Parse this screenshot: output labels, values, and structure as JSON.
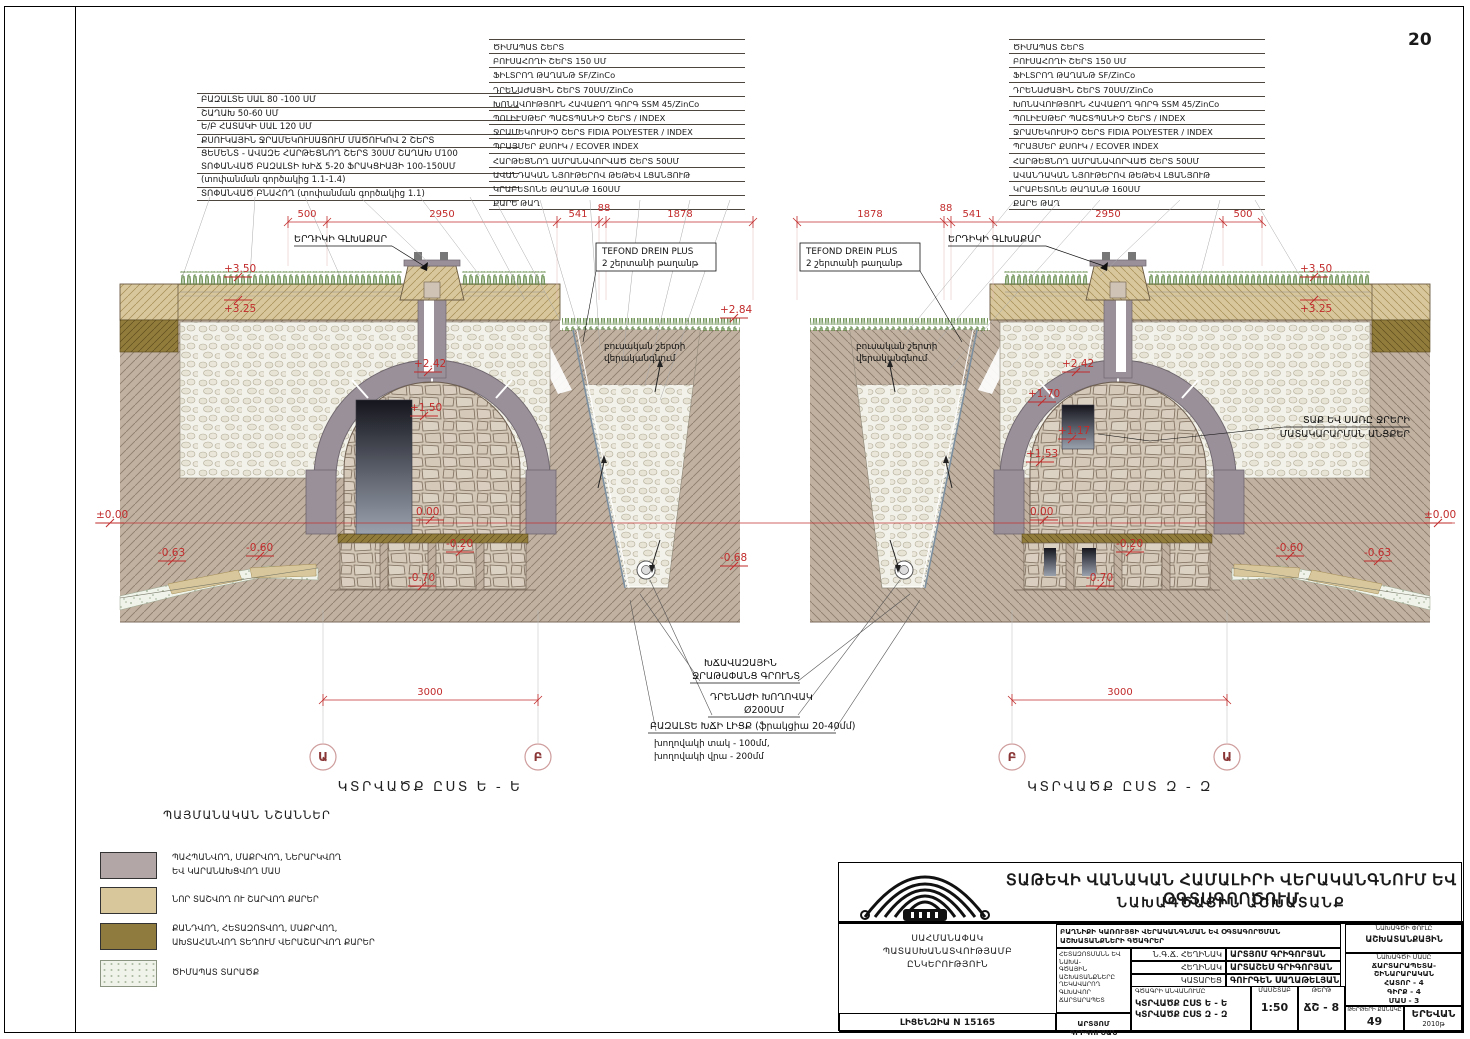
{
  "page": {
    "number": "20"
  },
  "colors": {
    "accent_red": "#c22b2b",
    "soil": "#c0b1a1",
    "roof_tan": "#d8c79d",
    "olive": "#927c3b",
    "stone": "#d2c6b6",
    "dome_gray": "#9a9099",
    "legend_mauve": "#b3a6a6",
    "legend_tan": "#d9c79c",
    "legend_olive": "#8f7b3e",
    "legend_speckle_bg": "#eff3ea"
  },
  "lists": {
    "floor_layers": [
      "ԲԱԶԱԼՏԵ ՍԱԼ 80 -100 ՍՄ",
      "ՇԱՂԱԽ 50-60 ՍՄ",
      "Ե/Բ ՀԱՏԱԿԻ ՍԱԼ 120 ՍՄ",
      "ՔՍՈՒԿԱՅԻՆ ՋՐԱՄԵԿՈՒՍԱՑՈՒՄ ՄԱԾՈՒԿՈՎ 2 ՇԵՐՏ",
      "ՑԵՄԵՆՏ - ԱՎԱԶԵ ՀԱՐԹԵՑՆՈՂ ՇԵՐՏ 30ՍՄ ՇԱՂԱԽ Մ100",
      "ՏՈՓԱՆՎԱԾ ԲԱԶԱԼՏԻ ԽԻՃ 5-20 ՖՐԱԿՑԻԱՅԻ 100-150ՍՄ",
      "(տոփանման գործակից 1.1-1.4)",
      "ՏՈՓԱՆՎԱԾ ԲՆԱՀՈՂ (տոփանման գործակից 1.1)"
    ],
    "roof_layers": [
      "ԾԻՄԱՊԱՏ ՇԵՐՏ",
      "ԲՈՒՍԱՀՈՂԻ ՇԵՐՏ 150 ՍՄ",
      "ՖԻԼՏՐՈՂ ԹԱՂԱՆԹ SF/ZinCo",
      "ԴՐԵՆԱԺԱՅԻՆ ՇԵՐՏ 70ՍՄ/ZinCo",
      "ԽՈՆԱՎՈՒԹՅՈՒՆ ՀԱՎԱՔՈՂ ԳՈՐԳ SSM 45/ZinCo",
      "ՊՈԼԻԷՍԹԵՐ ՊԱՇՏՊԱՆԻՉ ՇԵՐՏ / INDEX",
      "ՋՐԱՄԵԿՈՒՍԻՉ ՇԵՐՏ FIDIA POLYESTER / INDEX",
      "ՊՐԱՅՄԵՐ ՔՍՈՒԿ / ECOVER INDEX",
      "ՀԱՐԹԵՑՆՈՂ ԱՄՐԱՆԱՎՈՐՎԱԾ ՇԵՐՏ 50ՍՄ",
      "ԱՎԱՆԴԱԿԱՆ ՆՅՈՒԹԵՐՈՎ ԹԵԹԵՎ ԼՑԱՆՅՈՒԹ",
      "ԿՐԱԲԵՏՈՆԵ ԹԱՂԱՆԹ 160ՍՄ",
      "ՔԱՐԵ ԹԱՂ"
    ]
  },
  "sections": {
    "left": {
      "title": "ԿՏՐՎԱԾՔ ԸՍՏ Ե - Ե",
      "axis_a": "Ա",
      "axis_b": "Բ",
      "span": "3000",
      "dims": [
        "500",
        "2950",
        "541",
        "88",
        "1878"
      ],
      "marks": {
        "p350": "+3.50",
        "p325": "+3.25",
        "zero": "±0.00",
        "m063": "-0.63",
        "m060": "-0.60",
        "p242": "+2.42",
        "p150": "+1.50",
        "floor": "0.00",
        "m020": "-0.20",
        "m070": "-0.70",
        "p284": "+2.84",
        "m068": "-0.68"
      },
      "skylight": "ԵՐԴԻԿԻ ԳԼԽԱՔԱՐ",
      "tefond1": "TEFOND DREIN PLUS",
      "tefond2": "2 շերտանի թաղանթ",
      "veg1": "բուսական շերտի",
      "veg2": "վերականգնում"
    },
    "right": {
      "title": "ԿՏՐՎԱԾՔ ԸՍՏ Զ - Զ",
      "axis_a": "Ա",
      "axis_b": "Բ",
      "span": "3000",
      "dims": [
        "1878",
        "88",
        "541",
        "2950",
        "500"
      ],
      "marks": {
        "p350": "+3.50",
        "p325": "+3.25",
        "zero": "±0.00",
        "m063": "-0.63",
        "m060": "-0.60",
        "p242": "+2.42",
        "p170": "+1.70",
        "p117": "+1.17",
        "p153": "+1.53",
        "floor": "0.00",
        "m020": "-0.20",
        "m070": "-0.70"
      },
      "skylight": "ԵՐԴԻԿԻ ԳԼԽԱՔԱՐ",
      "tefond1": "TEFOND DREIN PLUS",
      "tefond2": "2 շերտանի թաղանթ",
      "veg1": "բուսական շերտի",
      "veg2": "վերականգնում",
      "water1": "ՏԱՔ ԵՎ ՍԱՌԸ ՋՐԵՐԻ",
      "water2": "ՄԱՏԱԿԱՐԱՐՄԱՆ ԱՆՑՔԵՐ"
    }
  },
  "notes": {
    "gravel1": "ԽՃԱՎԱԶԱՅԻՆ",
    "gravel2": "ՋՐԱԹԱՓԱՆՑ ԳՐՈՒՆՏ",
    "pipe1": "ԴՐԵՆԱԺԻ ԽՈՂՈՎԱԿ",
    "pipe2": "Ø200ՍՄ",
    "basalt1": "ԲԱԶԱԼՏԵ ԽՃԻ ԼԻՑՔ (ֆրակցիա 20-40մմ)",
    "basalt2": "խողովակի տակ - 100մմ,",
    "basalt3": "խողովակի վրա - 200մմ"
  },
  "legend": {
    "title": "ՊԱՅՄԱՆԱԿԱՆ ՆՇԱՆՆԵՐ",
    "items": [
      {
        "line1": "ՊԱՀՊԱՆՎՈՂ, ՄԱՔՐՎՈՂ, ՆԵՐԱՐԿՎՈՂ",
        "line2": "ԵՎ ԿԱՐԱՆԱԽՑՎՈՂ ՄԱՍ"
      },
      {
        "line1": "ՆՈՐ ՏԱՇՎՈՂ ՈՒ ՇԱՐՎՈՂ ՔԱՐԵՐ",
        "line2": ""
      },
      {
        "line1": "ՔԱՆԴՎՈՂ, ՀԵՏԱԶՈՏՎՈՂ, ՄԱՔՐՎՈՂ,",
        "line2": "ԱԽՏԱՀԱՆՎՈՂ ՏԵՂՈՒՄ ՎԵՐԱՇԱՐՎՈՂ ՔԱՐԵՐ"
      },
      {
        "line1": "ԾԻՄԱՊԱՏ ՏԱՐԱԾՔ",
        "line2": ""
      }
    ]
  },
  "titleblock": {
    "project_title1": "ՏԱԹԵՎԻ ՎԱՆԱԿԱՆ ՀԱՄԱԼԻՐԻ ՎԵՐԱԿԱՆԳՆՈՒՄ ԵՎ ՕԳՏԱԳՈՐԾՈՒՄ",
    "project_title2": "ՆԱԽԱԳԾԱՅԻՆ ԱՇԽԱՏԱՆՔ",
    "company1": "ՍԱՀՄԱՆԱՓԱԿ",
    "company2": "ՊԱՏԱՍԽԱՆԱՏՎՈՒԹՅԱՄԲ",
    "company3": "ԸՆԿԵՐՈՒԹՅՈՒՆ",
    "license": "ԼԻՑԵՆԶԻԱ N 15165",
    "works_title1": "ԲԱՂՆԻՔԻ ԿԱՌՈՒՅՑԻ ՎԵՐԱԿԱՆԳՆՄԱՆ ԵՎ ՕԳՏԱԳՈՐԾՄԱՆ",
    "works_title2": "ԱՇԽԱՏԱՆՔՆԵՐԻ ԳԾԱԳՐԵՐ",
    "chief1": "ՀԵՏԱԶՈՏՄԱՆՆ ԵՎ ՆԱԽԱ-",
    "chief2": "ԳԾԱՅԻՆ ԱՇԽԱՏԱՆՔՆԵՐԸ",
    "chief3": "ՂԵԿԱՎԱՐՈՂ ԳԼԽԱՎՈՐ",
    "chief4": "ՃԱՐՏԱՐԱՊԵՏ",
    "roles": [
      {
        "role": "Ն.Գ.Ճ. ՀԵՂԻՆԱԿ",
        "name": "ԱՐՏՅՈՄ ԳՐԻԳՈՐՅԱՆ"
      },
      {
        "role": "ՀԵՂԻՆԱԿ",
        "name": "ԱՐՏԱՇԵՍ ԳՐԻԳՈՐՅԱՆ"
      },
      {
        "role": "ԿԱՏԱՐԵՑ",
        "name": "ԳՈՒՐԳԵՆ ՍԱՂԱԹԵԼՅԱՆ"
      }
    ],
    "chief_name": "ԱՐՏՅՈՄ ԳՐԻԳՈՐՅԱՆ",
    "drawing_label": "ԳԾԱԳՐԻ ԱՆՎԱՆՈՒՄԸ",
    "drawing1": "ԿՏՐՎԱԾՔ ԸՍՏ Ե - Ե",
    "drawing2": "ԿՏՐՎԱԾՔ ԸՍՏ Զ - Զ",
    "stage_label": "ՆԱԽԱԳԾԻ ՓՈՒԼԸ",
    "stage": "ԱՇԽԱՏԱՆՔԱՅԻՆ",
    "part_label": "ՆԱԽԱԳԾԻ ՄԱՍԸ",
    "part1": "ՃԱՐՏԱՐԱՊԵՏԱ-",
    "part2": "ՇԻՆԱՐԱՐԱԿԱՆ",
    "part3": "ՀԱՏՈՐ - 4",
    "part4": "ԳԻՐՔ - 4",
    "part5": "ՄԱՍ - 3",
    "scale_label": "ՄԱՍՇՏԱԲ",
    "scale": "1:50",
    "sheet_label": "ԹԵՐԹ",
    "sheet_code": "ՃՇ - 8",
    "sheets_label": "ԹԵՐԹԵՐԻ ՔԱՆԱԿԸ",
    "sheets_count": "49",
    "city": "ԵՐԵՎԱՆ",
    "year": "2010թ"
  }
}
